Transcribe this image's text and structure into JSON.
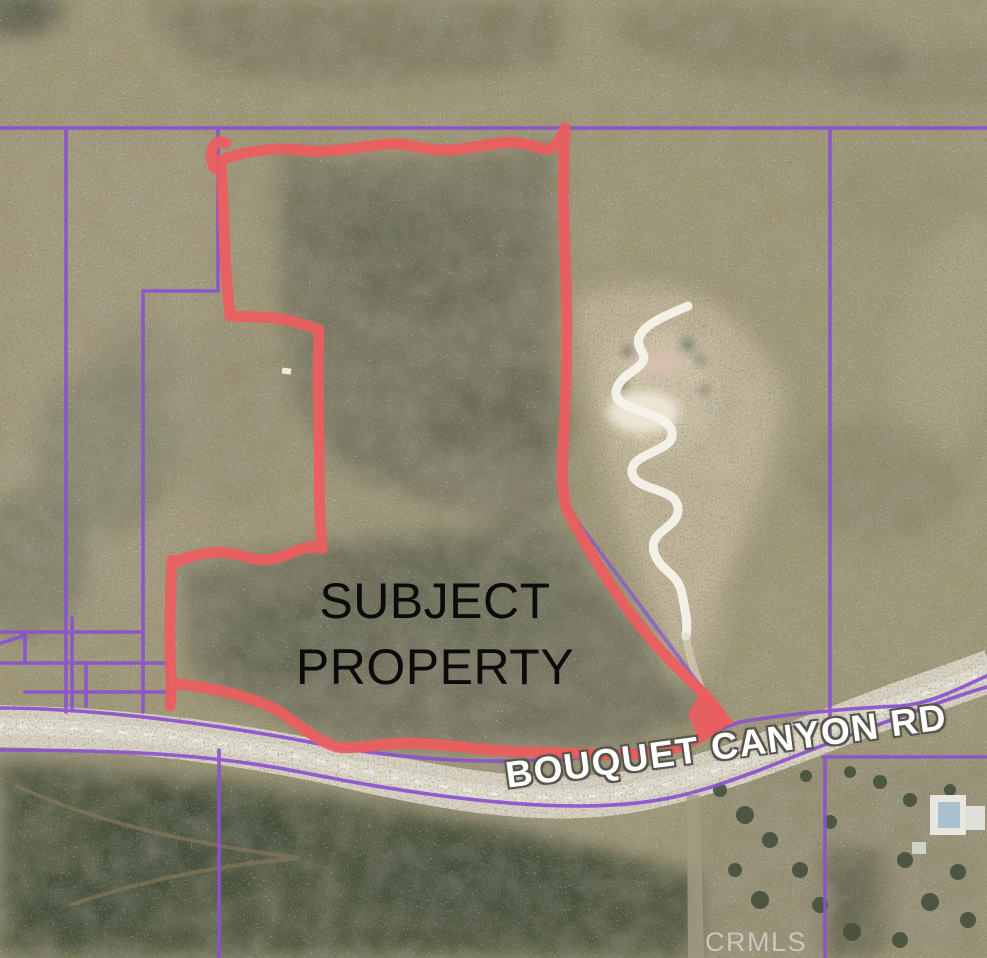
{
  "map": {
    "subject_property": {
      "line1": "SUBJECT",
      "line2": "PROPERTY"
    },
    "road_label": "BOUQUET CANYON RD",
    "watermark": "CRMLS"
  },
  "colors": {
    "parcel_line": "#8a52cf",
    "property_outline": "#ec5e5f",
    "road_fill": "#d8d2c3",
    "subject_text": "#0b0b0b",
    "road_text": "#ffffff",
    "watermark_text": "#d6d4cd"
  }
}
